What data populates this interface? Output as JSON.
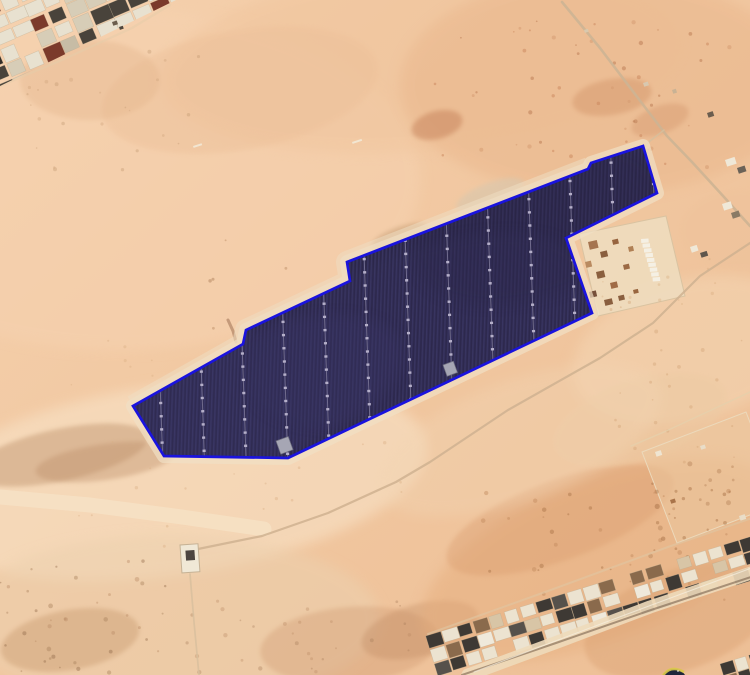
{
  "canvas": {
    "width": 750,
    "height": 675
  },
  "scene": {
    "kind": "satellite-imagery",
    "subject": "desert-solar-farm-site-with-blue-boundary-overlay"
  },
  "palette": {
    "bg_top": "#f5d1ae",
    "bg_mid": "#f1c7a0",
    "bg_bottom": "#edbf96",
    "farm_fill": "#332f56",
    "stripe_dark": "#292545",
    "stripe_light": "#423d6e",
    "outline_blue": "#1a13de",
    "halo": "#f1e0c5",
    "halo_topleft": "#efddc1"
  },
  "terrain": {
    "patches": [
      {
        "cx": 120,
        "cy": 180,
        "rx": 300,
        "ry": 170,
        "rot": 0,
        "c": "#f6d2b0",
        "o": 0.55,
        "f": "b1"
      },
      {
        "cx": 420,
        "cy": 60,
        "rx": 260,
        "ry": 90,
        "rot": -5,
        "c": "#f0c49c",
        "o": 0.5,
        "f": "b1"
      },
      {
        "cx": 600,
        "cy": 85,
        "rx": 200,
        "ry": 110,
        "rot": 0,
        "c": "#e9b68b",
        "o": 0.5,
        "f": "b1"
      },
      {
        "cx": 437,
        "cy": 125,
        "rx": 26,
        "ry": 14,
        "rot": -15,
        "c": "#c17a52",
        "o": 0.45,
        "f": "b2"
      },
      {
        "cx": 612,
        "cy": 97,
        "rx": 40,
        "ry": 18,
        "rot": -10,
        "c": "#cf8f63",
        "o": 0.4,
        "f": "b2"
      },
      {
        "cx": 660,
        "cy": 120,
        "rx": 30,
        "ry": 14,
        "rot": -20,
        "c": "#d09066",
        "o": 0.35,
        "f": "b2"
      },
      {
        "cx": 170,
        "cy": 480,
        "rx": 260,
        "ry": 95,
        "rot": -8,
        "c": "#f8e2c6",
        "o": 0.6,
        "f": "b1"
      },
      {
        "cx": 60,
        "cy": 455,
        "rx": 90,
        "ry": 26,
        "rot": -12,
        "c": "#c49a74",
        "o": 0.5,
        "f": "b2"
      },
      {
        "cx": 105,
        "cy": 462,
        "rx": 70,
        "ry": 18,
        "rot": -8,
        "c": "#bd8f6a",
        "o": 0.4,
        "f": "b2"
      },
      {
        "cx": 170,
        "cy": 620,
        "rx": 210,
        "ry": 85,
        "rot": 0,
        "c": "#ecd0ae",
        "o": 0.55,
        "f": "b1"
      },
      {
        "cx": 70,
        "cy": 640,
        "rx": 70,
        "ry": 30,
        "rot": -10,
        "c": "#c09064",
        "o": 0.35,
        "f": "b2"
      },
      {
        "cx": 350,
        "cy": 645,
        "rx": 90,
        "ry": 38,
        "rot": -5,
        "c": "#c99068",
        "o": 0.3,
        "f": "b2"
      },
      {
        "cx": 420,
        "cy": 630,
        "rx": 60,
        "ry": 26,
        "rot": -15,
        "c": "#b9835c",
        "o": 0.3,
        "f": "b2"
      },
      {
        "cx": 600,
        "cy": 560,
        "rx": 190,
        "ry": 80,
        "rot": -22,
        "c": "#e6ae7e",
        "o": 0.5,
        "f": "b1"
      },
      {
        "cx": 560,
        "cy": 520,
        "rx": 120,
        "ry": 40,
        "rot": -20,
        "c": "#d89a6c",
        "o": 0.35,
        "f": "b2"
      },
      {
        "cx": 690,
        "cy": 350,
        "rx": 120,
        "ry": 70,
        "rot": -15,
        "c": "#f4d7b5",
        "o": 0.5,
        "f": "b1"
      },
      {
        "cx": 640,
        "cy": 420,
        "rx": 90,
        "ry": 40,
        "rot": -18,
        "c": "#eccaa3",
        "o": 0.45,
        "f": "b2"
      },
      {
        "cx": 240,
        "cy": 90,
        "rx": 140,
        "ry": 60,
        "rot": -10,
        "c": "#ecbf98",
        "o": 0.4,
        "f": "b2"
      },
      {
        "cx": 90,
        "cy": 80,
        "rx": 70,
        "ry": 40,
        "rot": 0,
        "c": "#e2b38a",
        "o": 0.35,
        "f": "b2"
      },
      {
        "cx": 400,
        "cy": 237,
        "rx": 30,
        "ry": 10,
        "rot": -20,
        "c": "#c8a078",
        "o": 0.55,
        "f": "b2"
      },
      {
        "cx": 490,
        "cy": 195,
        "rx": 36,
        "ry": 12,
        "rot": -21,
        "c": "#d8c7ae",
        "o": 0.6,
        "f": "b2"
      },
      {
        "cx": 300,
        "cy": 330,
        "rx": 60,
        "ry": 25,
        "rot": -25,
        "c": "#f3dcbf",
        "o": 0.5,
        "f": "b2"
      },
      {
        "cx": 520,
        "cy": 440,
        "rx": 150,
        "ry": 60,
        "rot": -20,
        "c": "#f2d4b2",
        "o": 0.4,
        "f": "b1"
      },
      {
        "cx": 680,
        "cy": 620,
        "rx": 100,
        "ry": 50,
        "rot": -20,
        "c": "#d99f6f",
        "o": 0.4,
        "f": "b2"
      },
      {
        "cx": 740,
        "cy": 230,
        "rx": 60,
        "ry": 40,
        "rot": 0,
        "c": "#eec29b",
        "o": 0.4,
        "f": "b2"
      }
    ],
    "speckles": [
      {
        "seed": 11,
        "n": 50,
        "x": 430,
        "y": 20,
        "w": 320,
        "h": 150,
        "rmin": 0.8,
        "rmax": 2.2,
        "o": 0.5,
        "cols": [
          "#c9855c",
          "#b97a52",
          "#d49a70"
        ]
      },
      {
        "seed": 23,
        "n": 18,
        "x": 200,
        "y": 230,
        "w": 220,
        "h": 115,
        "rmin": 0.8,
        "rmax": 1.8,
        "o": 0.45,
        "cols": [
          "#b98a62",
          "#a87a55"
        ]
      },
      {
        "seed": 31,
        "n": 40,
        "x": 0,
        "y": 560,
        "w": 170,
        "h": 115,
        "rmin": 0.8,
        "rmax": 2.4,
        "o": 0.4,
        "cols": [
          "#b98a63",
          "#a67c58",
          "#8f6747"
        ]
      },
      {
        "seed": 47,
        "n": 30,
        "x": 180,
        "y": 600,
        "w": 280,
        "h": 75,
        "rmin": 0.8,
        "rmax": 2.2,
        "o": 0.35,
        "cols": [
          "#b98a63",
          "#a67c58"
        ]
      },
      {
        "seed": 53,
        "n": 45,
        "x": 480,
        "y": 490,
        "w": 270,
        "h": 110,
        "rmin": 0.8,
        "rmax": 2.4,
        "o": 0.45,
        "cols": [
          "#c28a5d",
          "#a97448"
        ]
      },
      {
        "seed": 61,
        "n": 35,
        "x": 60,
        "y": 330,
        "w": 360,
        "h": 230,
        "rmin": 0.7,
        "rmax": 1.8,
        "o": 0.4,
        "cols": [
          "#d9ae85"
        ]
      },
      {
        "seed": 71,
        "n": 25,
        "x": 10,
        "y": 50,
        "w": 190,
        "h": 120,
        "rmin": 0.7,
        "rmax": 2.0,
        "o": 0.4,
        "cols": [
          "#cfa67e",
          "#c39a72"
        ]
      },
      {
        "seed": 83,
        "n": 25,
        "x": 600,
        "y": 300,
        "w": 150,
        "h": 170,
        "rmin": 0.7,
        "rmax": 2.0,
        "o": 0.4,
        "cols": [
          "#d3a275"
        ]
      },
      {
        "seed": 97,
        "n": 22,
        "x": 648,
        "y": 450,
        "w": 100,
        "h": 110,
        "rmin": 1.0,
        "rmax": 2.6,
        "o": 0.5,
        "cols": [
          "#bb8a5f",
          "#a9744a"
        ]
      },
      {
        "seed": 101,
        "n": 12,
        "x": 600,
        "y": 250,
        "w": 120,
        "h": 80,
        "rmin": 0.7,
        "rmax": 1.8,
        "o": 0.35,
        "cols": [
          "#d8a87c"
        ]
      }
    ]
  },
  "roads": [
    {
      "name": "left-sand-track",
      "layer": 0,
      "pts": [
        [
          0,
          497
        ],
        [
          90,
          505
        ],
        [
          182,
          517
        ],
        [
          264,
          529
        ]
      ],
      "w": 15,
      "c": "#f7e4c8",
      "o": 0.7
    },
    {
      "name": "urban-edge-road",
      "layer": 0,
      "pts": [
        [
          0,
          86
        ],
        [
          62,
          60
        ],
        [
          132,
          28
        ],
        [
          170,
          5
        ]
      ],
      "w": 2.2,
      "c": "#e6ccaa",
      "o": 0.55
    },
    {
      "name": "northeast-road",
      "layer": 0,
      "pts": [
        [
          562,
          2
        ],
        [
          600,
          48
        ],
        [
          641,
          102
        ],
        [
          667,
          136
        ],
        [
          692,
          162
        ],
        [
          724,
          197
        ],
        [
          750,
          226
        ]
      ],
      "w": 2.6,
      "c": "#cdb493",
      "o": 0.9
    },
    {
      "name": "apex-branch-track",
      "layer": 0,
      "pts": [
        [
          664,
          130
        ],
        [
          650,
          141
        ],
        [
          644,
          147
        ]
      ],
      "w": 1.6,
      "c": "#d6bf9e",
      "o": 0.8
    },
    {
      "name": "main-diagonal-road",
      "layer": 0,
      "pts": [
        [
          750,
          243
        ],
        [
          700,
          276
        ],
        [
          653,
          323
        ],
        [
          600,
          358
        ],
        [
          508,
          410
        ],
        [
          430,
          462
        ],
        [
          396,
          482
        ],
        [
          328,
          513
        ],
        [
          262,
          536
        ],
        [
          198,
          549
        ]
      ],
      "w": 2.2,
      "c": "#cfb290",
      "o": 0.85
    },
    {
      "name": "fence-line",
      "layer": 0,
      "pts": [
        [
          750,
          392
        ],
        [
          664,
          432
        ],
        [
          631,
          446
        ]
      ],
      "w": 1.5,
      "c": "#e6cfab",
      "o": 0.8
    },
    {
      "name": "outpost-track",
      "layer": 0,
      "pts": [
        [
          190,
          574
        ],
        [
          194,
          622
        ],
        [
          199,
          675
        ]
      ],
      "w": 1.7,
      "c": "#d8bf9e",
      "o": 0.85
    },
    {
      "name": "boundary-track-mark",
      "layer": 0,
      "pts": [
        [
          228,
          320
        ],
        [
          233,
          331
        ],
        [
          236,
          342
        ]
      ],
      "w": 3,
      "c": "#96684a",
      "o": 0.5
    },
    {
      "name": "strip-upper-road",
      "layer": 1,
      "pts": [
        [
          428,
          634
        ],
        [
          548,
          591
        ],
        [
          668,
          547
        ],
        [
          755,
          517
        ]
      ],
      "w": 2,
      "c": "#e0c7a3",
      "o": 0.6
    },
    {
      "name": "strip-lower-road",
      "layer": 1,
      "pts": [
        [
          468,
          675
        ],
        [
          560,
          641
        ],
        [
          650,
          607
        ],
        [
          757,
          571
        ]
      ],
      "w": 13,
      "c": "#eedaba",
      "o": 0.9
    },
    {
      "name": "strip-road-darkline",
      "layer": 1,
      "pts": [
        [
          462,
          675
        ],
        [
          556,
          643
        ],
        [
          648,
          611
        ],
        [
          757,
          575
        ]
      ],
      "w": 2,
      "c": "#6f5743",
      "o": 0.55
    },
    {
      "name": "strip-road-whiteline",
      "layer": 1,
      "pts": [
        [
          474,
          672
        ],
        [
          566,
          637
        ],
        [
          657,
          603
        ],
        [
          757,
          566
        ]
      ],
      "w": 1,
      "c": "#f7efe0",
      "o": 0.7
    }
  ],
  "plots": [
    {
      "name": "facility-compound-plot",
      "points": [
        [
          579,
          234
        ],
        [
          666,
          216
        ],
        [
          685,
          296
        ],
        [
          598,
          316
        ]
      ],
      "fill": "#eedcbe",
      "o": 0.9,
      "stroke": "#d9c3a1"
    },
    {
      "name": "fenced-plot-east",
      "points": [
        [
          642,
          452
        ],
        [
          746,
          412
        ],
        [
          781,
          503
        ],
        [
          677,
          543
        ]
      ],
      "fill": "#ebc9a2",
      "o": 0.5,
      "stroke": "#ecd9bb"
    }
  ],
  "compound": {
    "inner_squares": [
      [
        588,
        242,
        9,
        8,
        "#a57450"
      ],
      [
        600,
        252,
        7,
        6,
        "#8a5f3f"
      ],
      [
        585,
        262,
        6,
        6,
        "#b98a60"
      ],
      [
        612,
        240,
        6,
        5,
        "#97643f"
      ],
      [
        596,
        272,
        8,
        7,
        "#8a5f3f"
      ],
      [
        610,
        283,
        7,
        6,
        "#a06b45"
      ],
      [
        589,
        292,
        7,
        6,
        "#77503a"
      ],
      [
        604,
        300,
        8,
        6,
        "#8a5f3f"
      ],
      [
        623,
        265,
        6,
        5,
        "#9c6a44"
      ],
      [
        618,
        296,
        6,
        5,
        "#8a5f3f"
      ],
      [
        628,
        247,
        5,
        5,
        "#b08055"
      ],
      [
        633,
        290,
        5,
        4,
        "#99663f"
      ]
    ],
    "white_row": {
      "x": 641,
      "y": 239,
      "n": 9,
      "dx": 1.1,
      "dy": 4.9,
      "w": 7.5,
      "h": 4,
      "fill": "#f5f0e4"
    }
  },
  "clusters": [
    {
      "name": "urban-blocks-top-left",
      "layer": 1,
      "tx": -18,
      "ty": 6,
      "rot": -23,
      "rows": [
        -2,
        6
      ],
      "cols": [
        -2,
        13
      ],
      "cw": 17,
      "ch": 13,
      "gx": 2.5,
      "gy": 2.8,
      "seed": 7,
      "density": 0.93,
      "clip": "triClip",
      "palette": [
        [
          "#e8e1d0",
          5
        ],
        [
          "#d7cdb7",
          3
        ],
        [
          "#49433b",
          3
        ],
        [
          "#322d28",
          2
        ],
        [
          "#7b3a2b",
          1
        ],
        [
          "#2f6a59",
          1
        ],
        [
          "#c7bca5",
          1
        ]
      ]
    },
    {
      "name": "urban-strip-bottom",
      "layer": 1,
      "tx": 430,
      "ty": 650,
      "rot": -17,
      "rows": [
        -1,
        1
      ],
      "cols": [
        0,
        21
      ],
      "cw": 14,
      "ch": 12,
      "gx": 2.4,
      "gy": 2.6,
      "seed": 19,
      "density": 0.9,
      "clip": null,
      "palette": [
        [
          "#ece3d0",
          5
        ],
        [
          "#3e3934",
          4
        ],
        [
          "#8a6a4c",
          2
        ],
        [
          "#d8c5a6",
          2
        ],
        [
          "#56514b",
          1
        ],
        [
          "#efe9db",
          2
        ]
      ]
    },
    {
      "name": "urban-blocks-corner",
      "layer": 2,
      "tx": 720,
      "ty": 664,
      "rot": -17,
      "rows": [
        0,
        1
      ],
      "cols": [
        0,
        2
      ],
      "cw": 13,
      "ch": 11,
      "gx": 2,
      "gy": 2,
      "seed": 29,
      "density": 1,
      "clip": null,
      "palette": [
        [
          "#ece3d0",
          4
        ],
        [
          "#3e3934",
          3
        ],
        [
          "#8a6a4c",
          2
        ]
      ]
    }
  ],
  "buildings": [
    [
      725,
      160,
      10,
      7,
      "#efe8d8"
    ],
    [
      737,
      168,
      8,
      6,
      "#6b6257"
    ],
    [
      722,
      204,
      9,
      7,
      "#efe8d8"
    ],
    [
      731,
      213,
      8,
      6,
      "#8a7a65"
    ],
    [
      690,
      247,
      7,
      6,
      "#efe8d8"
    ],
    [
      700,
      253,
      7,
      5,
      "#5f564c"
    ],
    [
      643,
      83,
      5,
      4,
      "#d8c8b0"
    ],
    [
      707,
      113,
      6,
      5,
      "#6b5d4e"
    ],
    [
      672,
      90,
      4,
      4,
      "#c9b294"
    ],
    [
      112,
      22,
      5,
      4,
      "#6b5d4d"
    ],
    [
      119,
      27,
      4,
      3,
      "#4f463c"
    ],
    [
      655,
      452,
      6,
      5,
      "#efe5d2"
    ],
    [
      700,
      446,
      5,
      4,
      "#e9ddc8"
    ],
    [
      739,
      516,
      6,
      5,
      "#e9ddc8"
    ],
    [
      670,
      500,
      5,
      4,
      "#a9744a"
    ],
    [
      584,
      30,
      4,
      3,
      "#d9c9ae"
    ],
    [
      193,
      146,
      9,
      2,
      "#f2e6d2"
    ],
    [
      352,
      142,
      10,
      2,
      "#f2e6d2"
    ]
  ],
  "site": {
    "vertices": [
      [
        643,
        146
      ],
      [
        591,
        163
      ],
      [
        588,
        169
      ],
      [
        347,
        262
      ],
      [
        350,
        281
      ],
      [
        246,
        330
      ],
      [
        243,
        344
      ],
      [
        133,
        406
      ],
      [
        164,
        456
      ],
      [
        288,
        458
      ],
      [
        592,
        313
      ],
      [
        566,
        238
      ],
      [
        657,
        193
      ]
    ],
    "halo_segment": [
      [
        589,
        168
      ],
      [
        347,
        262
      ],
      [
        350,
        281
      ],
      [
        246,
        330
      ],
      [
        243,
        344
      ],
      [
        133,
        406
      ]
    ],
    "fill": "#332f56",
    "outline": "#1a13de",
    "outline_w": 2.7,
    "halo": "#f1e0c5",
    "halo_w": 14,
    "halo_o": 0.7,
    "halo_seg_w": 22,
    "halo_seg_o": 0.55,
    "stripe_dark": "#292545",
    "stripe_light": "#423d6e",
    "lanes": {
      "count": 13,
      "x_start": 161,
      "spacing": 41.7,
      "ref_y": 410,
      "lean": 0.035,
      "y_top": 138,
      "y_bottom": 468,
      "base_color": "#7f7a9b",
      "base_w": 1,
      "base_o": 0.8,
      "dot_color": "#b5afc9",
      "dot_w": 3.1,
      "dash": "2.4 10.8"
    },
    "overlays": [
      {
        "cx": 260,
        "cy": 395,
        "rx": 150,
        "ry": 65,
        "rot": -20,
        "c": "#3d3869",
        "o": 0.32
      },
      {
        "cx": 540,
        "cy": 225,
        "rx": 130,
        "ry": 70,
        "rot": -20,
        "c": "#2b2846",
        "o": 0.38
      },
      {
        "cx": 420,
        "cy": 330,
        "rx": 180,
        "ry": 80,
        "rot": -20,
        "c": "#393461",
        "o": 0.22
      }
    ],
    "substations": [
      [
        276,
        441,
        13,
        14
      ],
      [
        443,
        365,
        11,
        12
      ]
    ],
    "substation_fill": "#a6a6b4"
  },
  "outpost": {
    "rect": [
      180,
      545,
      18,
      28
    ],
    "rot": -4,
    "fill": "#f0e8d6",
    "stroke": "#c6b295",
    "inner": [
      185,
      551,
      9,
      10
    ],
    "inner_fill": "#4c4540"
  },
  "watermark": {
    "cx": 674,
    "cy": 682,
    "r": 13,
    "body": "#20273c",
    "arc": "#d9c94b",
    "glint": "#f4efdf"
  },
  "clips": {
    "triClip": [
      [
        0,
        0
      ],
      [
        176,
        0
      ],
      [
        0,
        86
      ]
    ]
  }
}
